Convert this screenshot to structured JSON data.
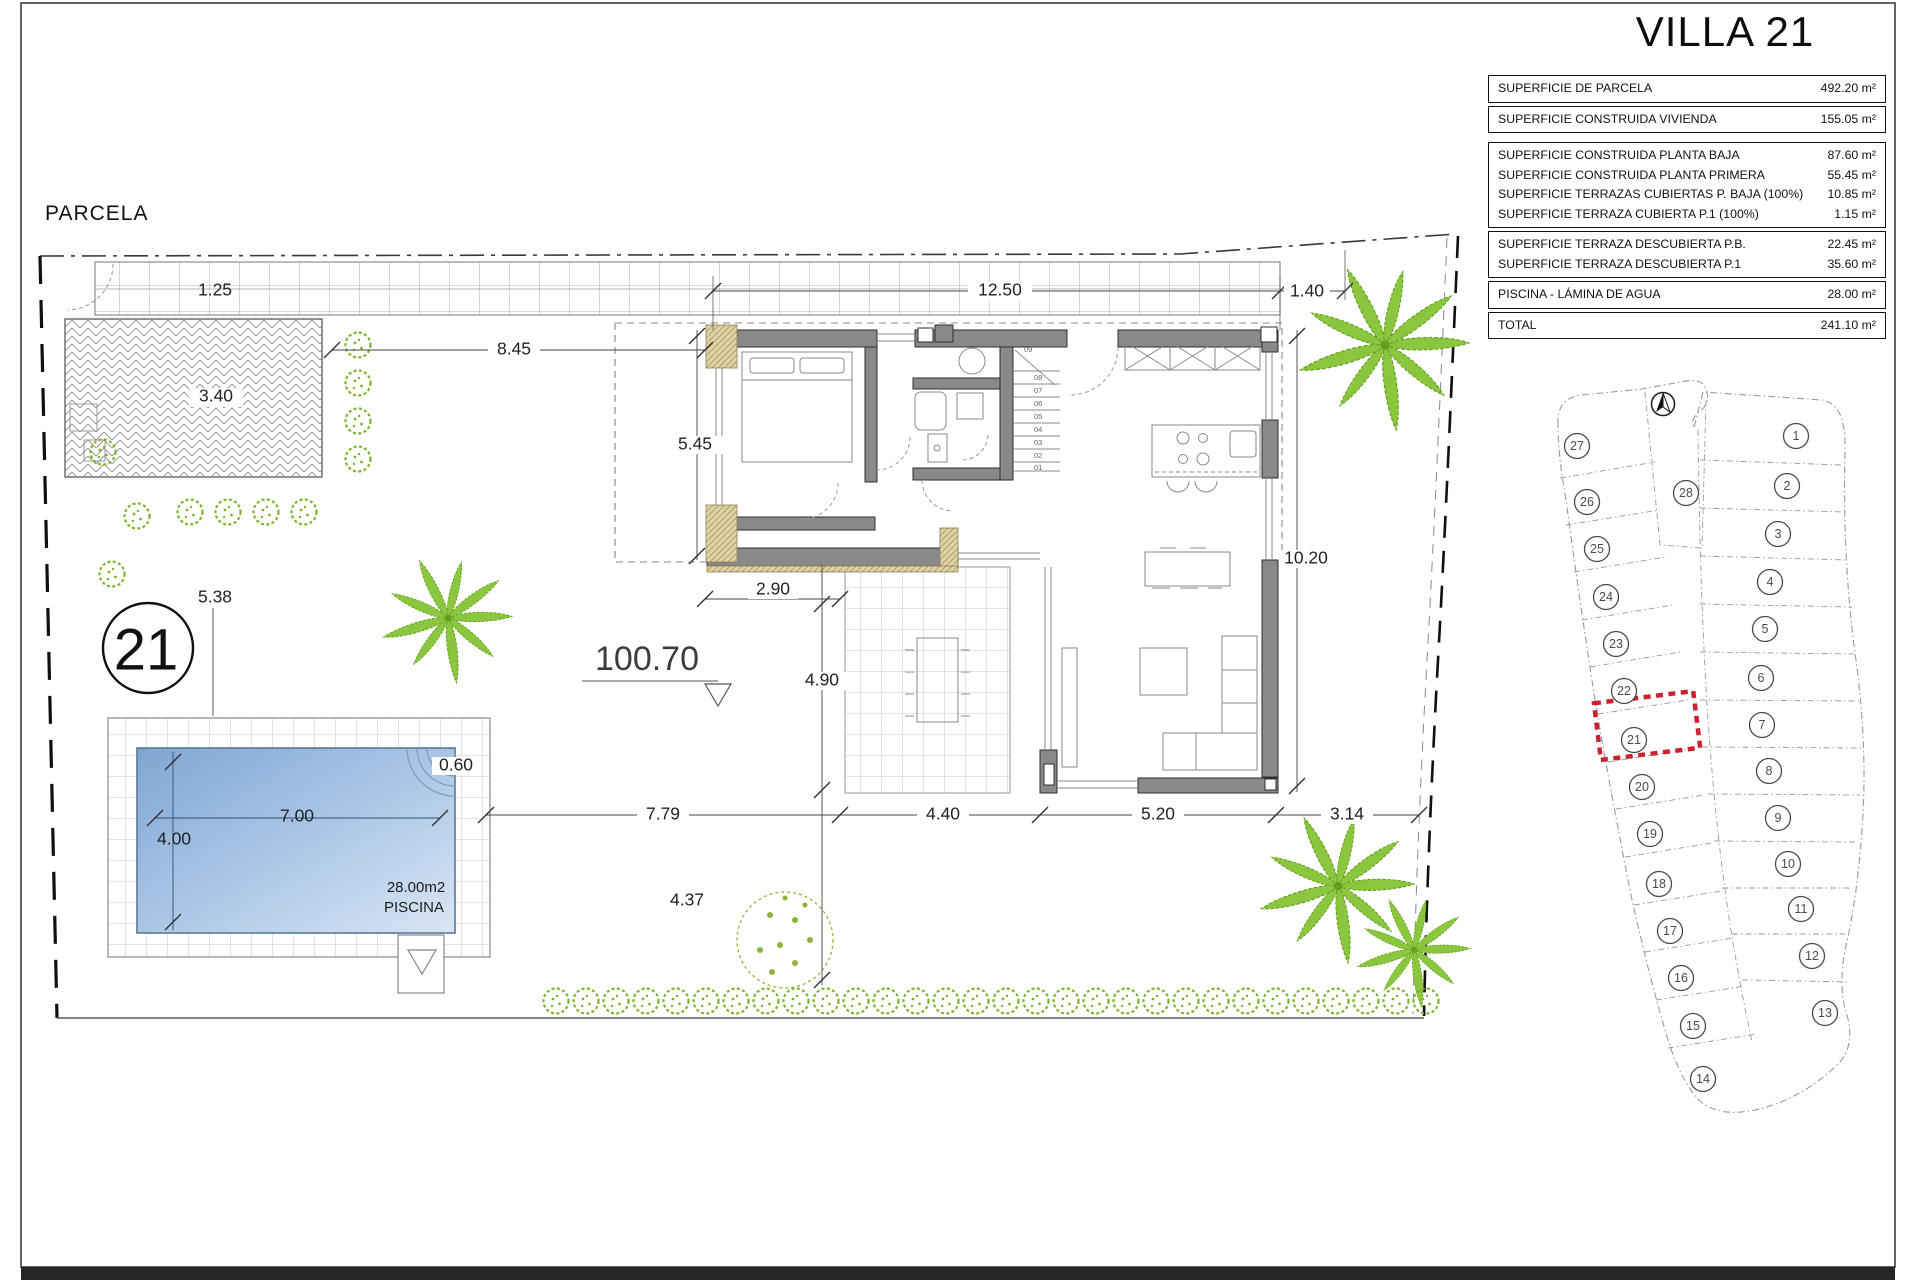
{
  "title": "VILLA 21",
  "parcela_label": "PARCELA",
  "plot_badge": "21",
  "area_table": {
    "groups": [
      {
        "rows": [
          {
            "label": "SUPERFICIE DE PARCELA",
            "value": "492.20 m²"
          }
        ]
      },
      {
        "rows": [
          {
            "label": "SUPERFICIE CONSTRUIDA VIVIENDA",
            "value": "155.05 m²"
          }
        ]
      },
      {
        "rows": [
          {
            "label": "SUPERFICIE CONSTRUIDA PLANTA BAJA",
            "value": "87.60 m²"
          },
          {
            "label": "SUPERFICIE CONSTRUIDA PLANTA PRIMERA",
            "value": "55.45 m²"
          },
          {
            "label": "SUPERFICIE TERRAZAS CUBIERTAS P. BAJA (100%)",
            "value": "10.85 m²"
          },
          {
            "label": "SUPERFICIE TERRAZA CUBIERTA P.1 (100%)",
            "value": "1.15 m²"
          }
        ]
      },
      {
        "rows": [
          {
            "label": "SUPERFICIE TERRAZA DESCUBIERTA P.B.",
            "value": "22.45 m²"
          },
          {
            "label": "SUPERFICIE TERRAZA DESCUBIERTA P.1",
            "value": "35.60 m²"
          }
        ]
      },
      {
        "rows": [
          {
            "label": "PISCINA - LÁMINA DE AGUA",
            "value": "28.00 m²"
          }
        ]
      },
      {
        "rows": [
          {
            "label": "TOTAL",
            "value": "241.10 m²"
          }
        ]
      }
    ]
  },
  "dims": {
    "walkway": "1.25",
    "driveway": "3.40",
    "garden_left": "8.45",
    "top_main": "12.50",
    "top_right": "1.40",
    "window_left": "5.45",
    "pool_side": "5.38",
    "porch": "2.90",
    "right_side": "10.20",
    "level": "100.70",
    "terrace_height": "4.90",
    "bottom_1": "7.79",
    "bottom_2": "4.40",
    "bottom_3": "5.20",
    "bottom_4": "3.14",
    "terrace_below": "4.37",
    "pool_length": "7.00",
    "pool_width": "4.00",
    "pool_deck": "0.60"
  },
  "pool": {
    "area": "28.00m2",
    "label": "PISCINA"
  },
  "stairs": [
    "01",
    "02",
    "03",
    "04",
    "05",
    "06",
    "07",
    "08",
    "09"
  ],
  "site_map": {
    "highlight_color": "#cf2030",
    "plots": [
      "1",
      "2",
      "3",
      "4",
      "5",
      "6",
      "7",
      "8",
      "9",
      "10",
      "11",
      "12",
      "13",
      "14",
      "15",
      "16",
      "17",
      "18",
      "19",
      "20",
      "21",
      "22",
      "23",
      "24",
      "25",
      "26",
      "27",
      "28"
    ]
  },
  "colors": {
    "vegetation": "#7cb52b",
    "walls": "#898989",
    "pool_water": "#8fb3da"
  }
}
